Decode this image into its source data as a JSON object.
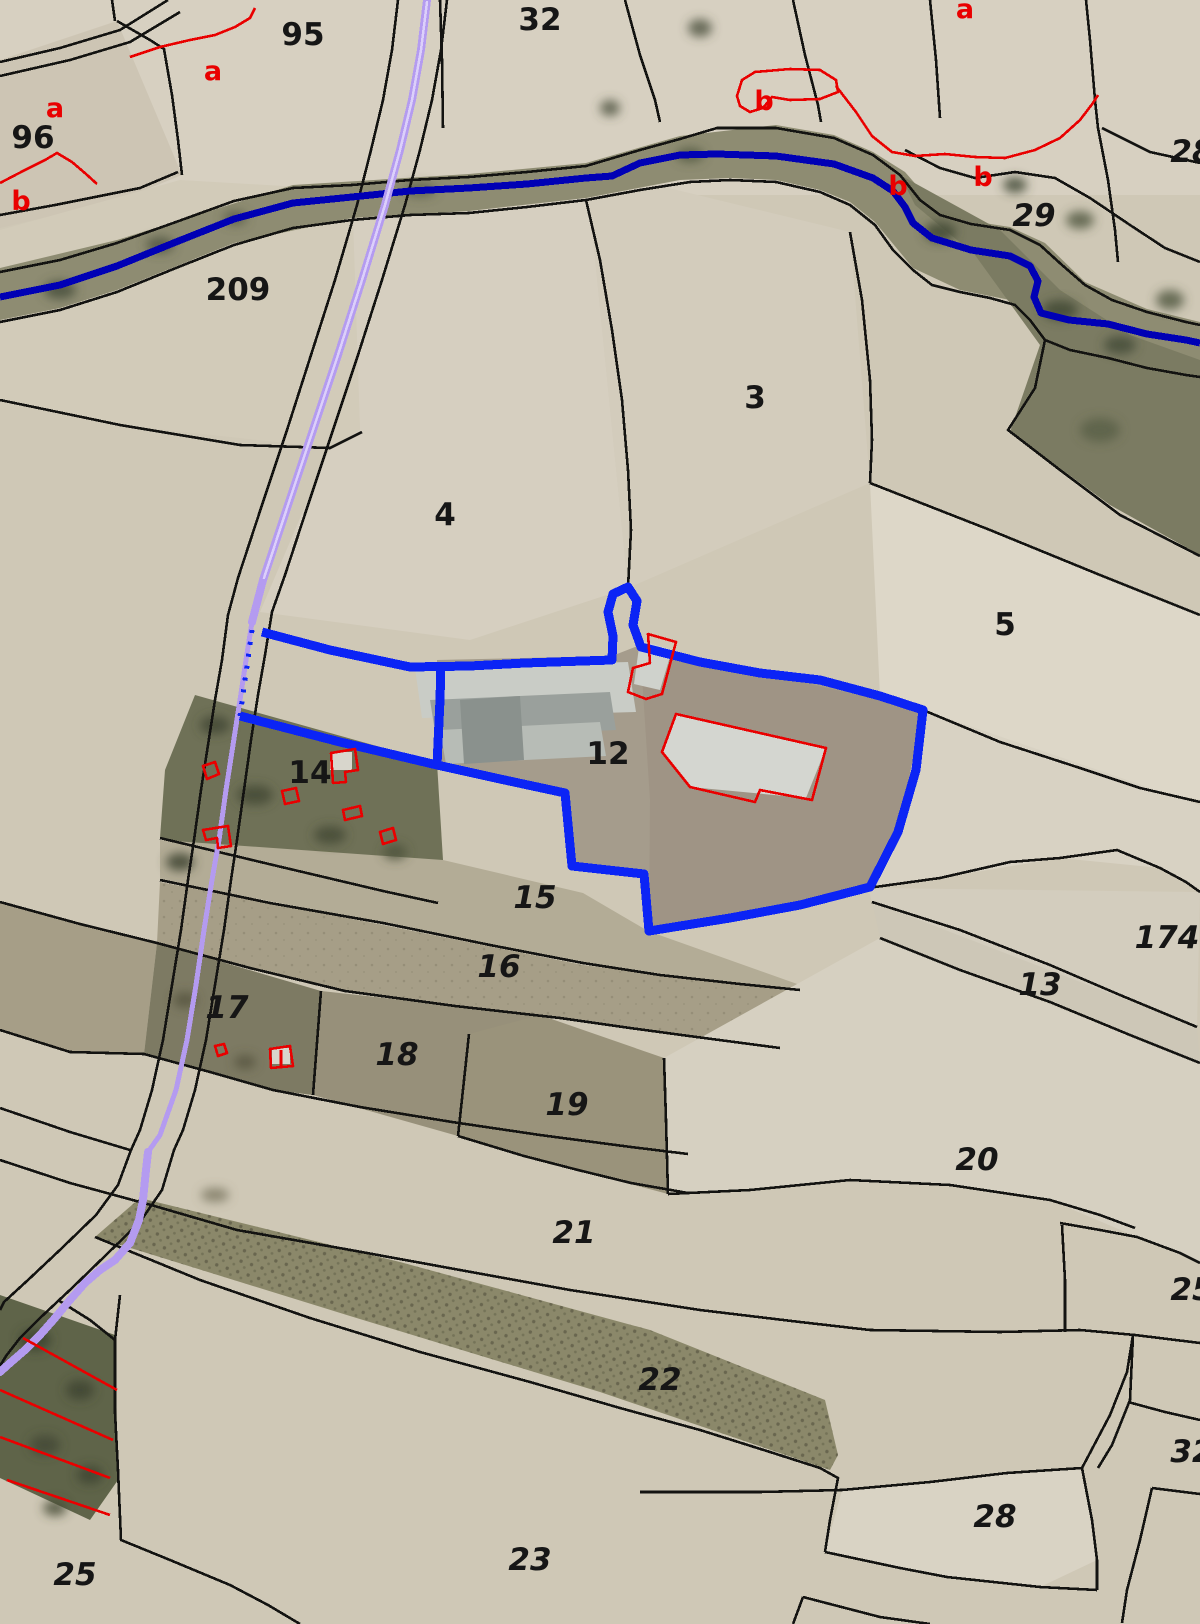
{
  "colors": {
    "background": "#cfc8b6",
    "boundary_black": "#131311",
    "river_blue": "#0000b5",
    "highlight_blue": "#0b24f5",
    "road_purple": "#b49bf0",
    "road_core": "#dcd0fa",
    "annotation_red": "#e90000",
    "label_black": "#161616"
  },
  "map": {
    "kind": "cadastral-parcel-map-over-aerial-photo",
    "highlighted_parcels": [
      "12",
      "14"
    ],
    "parcel_labels": [
      {
        "text": "95",
        "x": 303,
        "y": 45,
        "italic": false
      },
      {
        "text": "32",
        "x": 540,
        "y": 30,
        "italic": false
      },
      {
        "text": "96",
        "x": 33,
        "y": 148,
        "italic": false
      },
      {
        "text": "209",
        "x": 238,
        "y": 300,
        "italic": false
      },
      {
        "text": "3",
        "x": 755,
        "y": 408,
        "italic": false
      },
      {
        "text": "4",
        "x": 445,
        "y": 525,
        "italic": false
      },
      {
        "text": "5",
        "x": 1005,
        "y": 635,
        "italic": false
      },
      {
        "text": "12",
        "x": 608,
        "y": 764,
        "italic": false
      },
      {
        "text": "14",
        "x": 310,
        "y": 783,
        "italic": false
      },
      {
        "text": "15",
        "x": 535,
        "y": 908,
        "italic": true
      },
      {
        "text": "16",
        "x": 499,
        "y": 977,
        "italic": true
      },
      {
        "text": "17",
        "x": 227,
        "y": 1018,
        "italic": true
      },
      {
        "text": "18",
        "x": 397,
        "y": 1065,
        "italic": true
      },
      {
        "text": "19",
        "x": 567,
        "y": 1115,
        "italic": true
      },
      {
        "text": "13",
        "x": 1040,
        "y": 995,
        "italic": true
      },
      {
        "text": "174",
        "x": 1167,
        "y": 948,
        "italic": true
      },
      {
        "text": "20",
        "x": 977,
        "y": 1170,
        "italic": true
      },
      {
        "text": "21",
        "x": 574,
        "y": 1243,
        "italic": true
      },
      {
        "text": "22",
        "x": 660,
        "y": 1390,
        "italic": true
      },
      {
        "text": "23",
        "x": 530,
        "y": 1570,
        "italic": true
      },
      {
        "text": "25",
        "x": 75,
        "y": 1585,
        "italic": true
      },
      {
        "text": "28",
        "x": 995,
        "y": 1527,
        "italic": true
      },
      {
        "text": "29",
        "x": 1034,
        "y": 226,
        "italic": true
      },
      {
        "text": "28",
        "x": 1192,
        "y": 162,
        "italic": true
      },
      {
        "text": "25",
        "x": 1192,
        "y": 1300,
        "italic": true
      },
      {
        "text": "32",
        "x": 1192,
        "y": 1462,
        "italic": true
      }
    ],
    "subparcel_labels": [
      {
        "text": "a",
        "x": 213,
        "y": 80
      },
      {
        "text": "a",
        "x": 55,
        "y": 117
      },
      {
        "text": "b",
        "x": 21,
        "y": 210
      },
      {
        "text": "a",
        "x": 965,
        "y": 18
      },
      {
        "text": "b",
        "x": 764,
        "y": 110
      },
      {
        "text": "b",
        "x": 898,
        "y": 195
      },
      {
        "text": "b",
        "x": 983,
        "y": 186
      }
    ]
  }
}
